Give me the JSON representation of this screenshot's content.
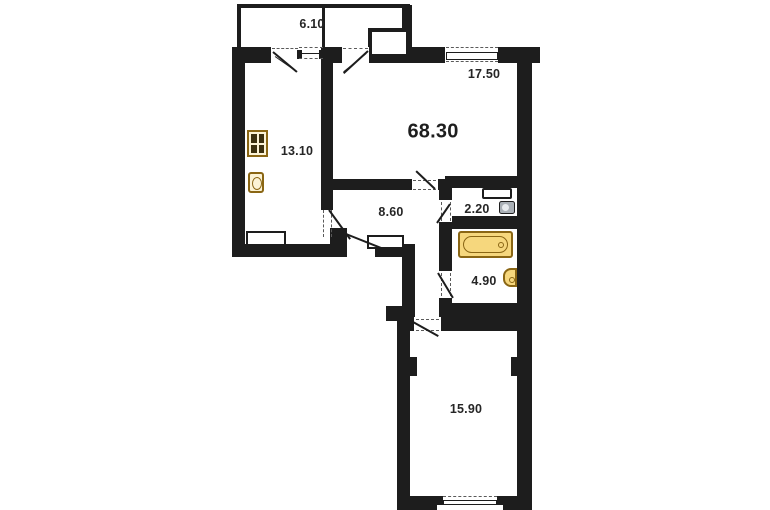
{
  "plan": {
    "type": "apartment-floor-plan",
    "total_area_label": "68.30",
    "rooms": {
      "balcony": "6.10",
      "living_room": "17.50",
      "kitchen": "13.10",
      "hallway": "8.60",
      "wc": "2.20",
      "bathroom": "4.90",
      "bedroom": "15.90"
    },
    "fixtures": [
      "stove-icon",
      "kitchen-sink-icon",
      "cistern-icon",
      "toilet-icon",
      "bathtub-icon",
      "bathroom-sink-icon"
    ],
    "colors": {
      "wall": "#1d1d1d",
      "background": "#ffffff",
      "fixture_fill": "#f6d77d",
      "fixture_border": "#8a6614",
      "label_text": "#262626"
    }
  }
}
